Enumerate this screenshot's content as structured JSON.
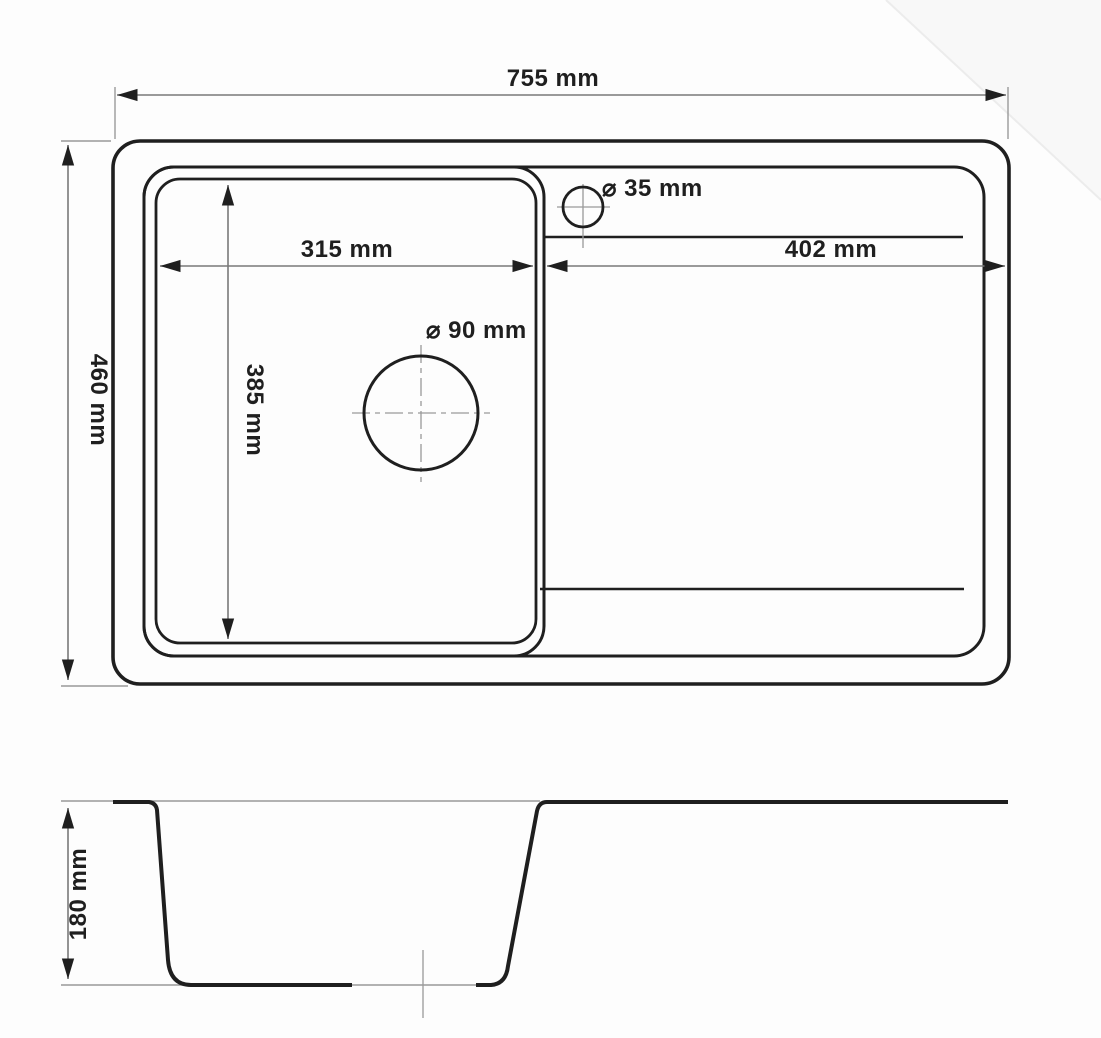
{
  "drawing": {
    "title": "kitchen sink dimension drawing",
    "colors": {
      "line": "#1f1f1f",
      "dim": "#7a7a7a",
      "dim_light": "#9a9a9a",
      "text": "#1f1f1f",
      "bg": "#fdfdfd"
    },
    "top_view": {
      "overall_width_label": "755 mm",
      "overall_depth_label": "460 mm",
      "bowl_width_label": "315 mm",
      "bowl_depth_label": "385 mm",
      "drainer_width_label": "402 mm",
      "tap_hole_diameter_label": "⌀ 35 mm",
      "drain_hole_diameter_label": "⌀ 90 mm"
    },
    "section_view": {
      "bowl_depth_label": "180 mm"
    }
  }
}
